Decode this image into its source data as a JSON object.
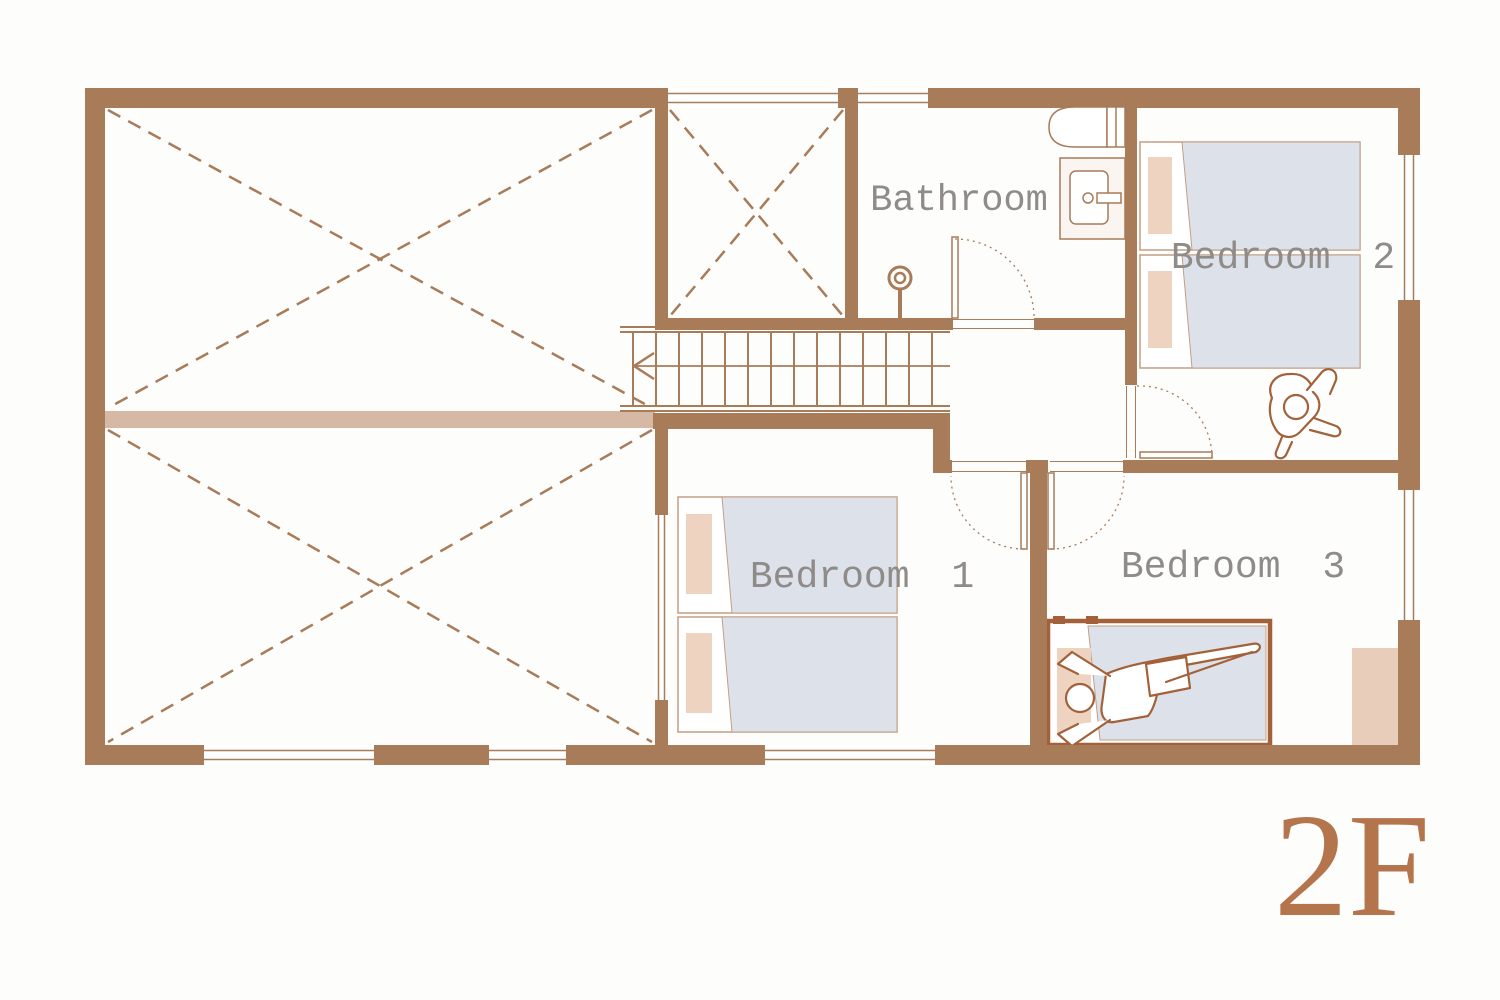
{
  "floor_label": "2F",
  "rooms": {
    "bathroom": {
      "label": "Bathroom"
    },
    "bedroom1": {
      "label": "Bedroom 1"
    },
    "bedroom2": {
      "label": "Bedroom 2"
    },
    "bedroom3": {
      "label": "Bedroom 3"
    }
  },
  "colors": {
    "wall": "#a87b59",
    "beam": "#d5b9a4",
    "bed_outline": "#c49e83",
    "bed_blanket": "#dde2ea",
    "pillow": "#eed3c1",
    "closet": "#e8cdbb",
    "furniture_outline": "#a3613a",
    "label_text": "#8e8b88",
    "floor_label_color": "#b5754c"
  }
}
